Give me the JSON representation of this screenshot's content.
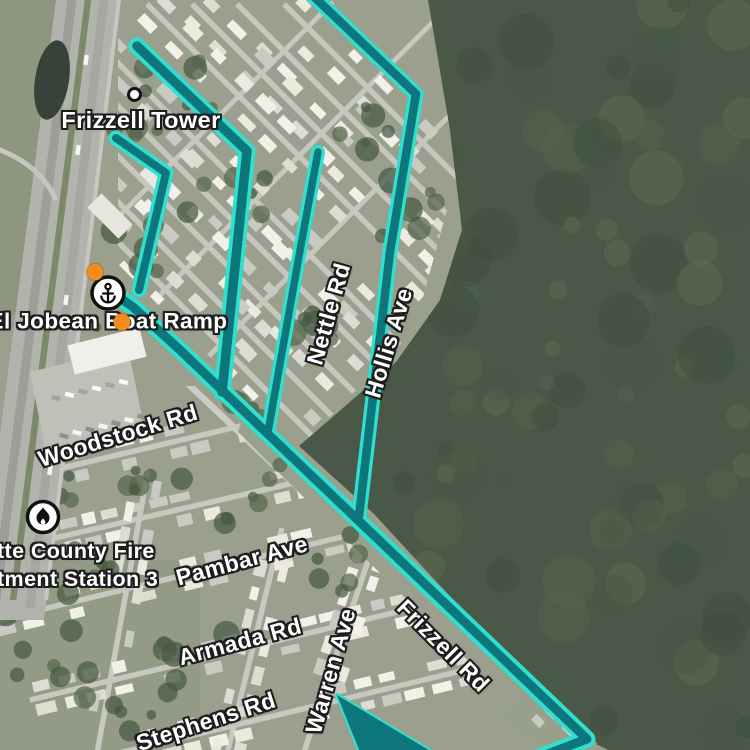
{
  "map": {
    "poi": {
      "tower": {
        "label": "Frizzell Tower"
      },
      "boat_ramp": {
        "label": "El Jobean Boat Ramp"
      },
      "fire_station": {
        "line1": "tte County Fire",
        "line2": "tment Station 3"
      }
    },
    "roads": {
      "woodstock": "Woodstock Rd",
      "pambar": "Pambar Ave",
      "armada": "Armada Rd",
      "stephens": "Stephens Rd",
      "warren": "Warren Ave",
      "nettle": "Nettle Rd",
      "hollis": "Hollis Ave",
      "frizzell": "Frizzell Rd"
    },
    "icons": {
      "boat_ramp": "anchor-icon",
      "fire_station": "flame-icon",
      "tower": "dot-marker"
    },
    "colors": {
      "route_edge": "#2fe0cf",
      "route_fill": "#0d767d",
      "marker_orange": "#f28c1e"
    }
  }
}
